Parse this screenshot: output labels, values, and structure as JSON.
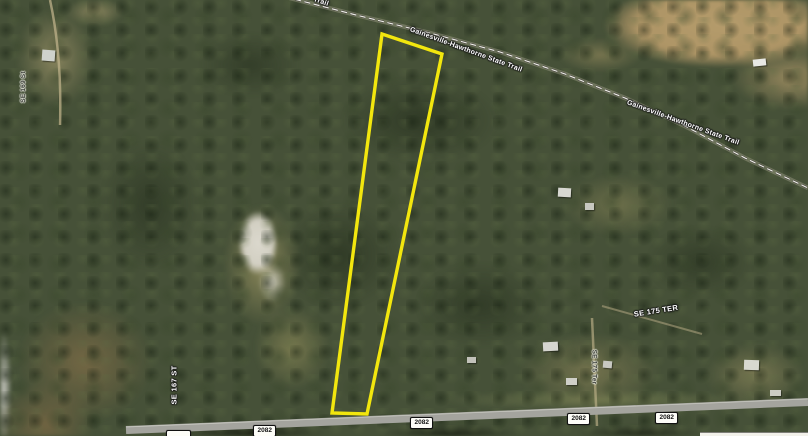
{
  "map": {
    "title": "Aerial parcel map with highlighted property boundary",
    "trail": {
      "name": "Gainesville-Hawthorne State Trail",
      "name_partial": "Trail"
    },
    "streets": {
      "se169": "SE 169 St",
      "se167": "SE 167 ST",
      "se175_upper": "SE 175 TER",
      "se175_lower": "SE 175 Ter"
    },
    "route_shields": [
      "2082",
      "2082",
      "2082",
      "2082"
    ],
    "colors": {
      "parcel_outline": "#f2e60e",
      "trail_line": "#f0f0ea",
      "road": "#a4a49e"
    }
  }
}
